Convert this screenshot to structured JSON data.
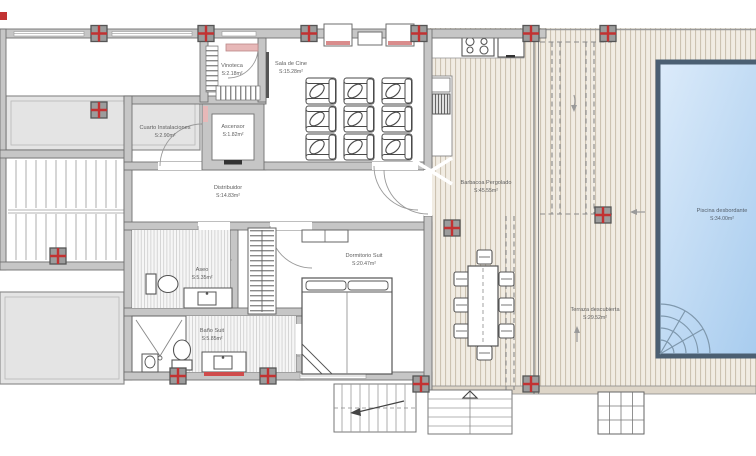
{
  "rooms": {
    "vinoteca": {
      "name": "Vinoteca",
      "area": "S:2.18m²"
    },
    "sala_de_cine": {
      "name": "Sala de Cine",
      "area": "S:15.28m²"
    },
    "cuarto_inst": {
      "name": "Cuarto Instalaciones",
      "area": "S:2.90m²"
    },
    "ascensor": {
      "name": "Ascensor",
      "area": "S:1.82m²"
    },
    "distribuidor": {
      "name": "Distribuidor",
      "area": "S:14.83m²"
    },
    "dormitorio": {
      "name": "Dormitorio Suit",
      "area": "S:20.47m²"
    },
    "aseo": {
      "name": "Aseo",
      "area": "S:5.35m²"
    },
    "bano_suit": {
      "name": "Baño Suit",
      "area": "S:5.85m²"
    },
    "barbacoa": {
      "name": "Barbacoa Pergolado",
      "area": "S:45.55m²"
    },
    "terraza": {
      "name": "Terraza descubierta",
      "area": "S:29.52m²"
    },
    "piscina": {
      "name": "Piscina desbordante",
      "area": "S:34.00m²"
    }
  },
  "colors": {
    "wall": "#c6c6c6",
    "wall_outline": "#707070",
    "slab": "#e4e4e4",
    "deck": "#f1ece3",
    "deck_slat": "#ccc2b1",
    "pool": "#b9d7f2",
    "pool_border": "#4b5f72",
    "column_red": "#c23232",
    "door_pink": "#e7b8b8",
    "label_text": "#5f5f5f",
    "background": "#ffffff"
  }
}
